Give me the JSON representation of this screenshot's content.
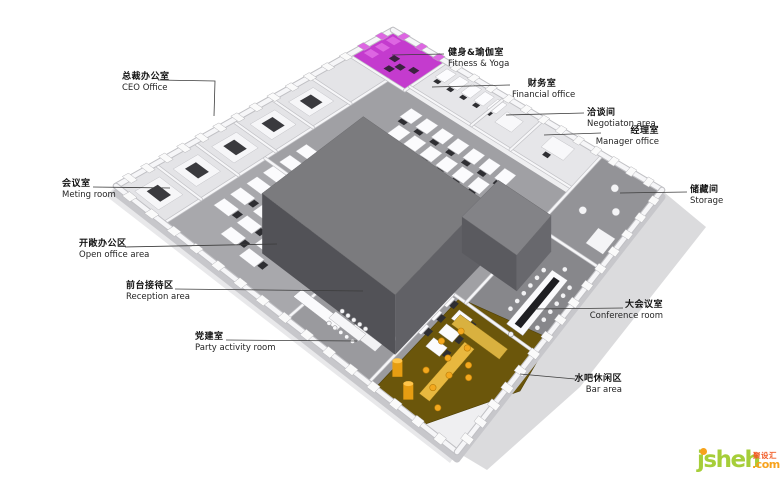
{
  "title": "Office floor plan 3D isometric diagram",
  "plan": {
    "colors": {
      "fitness": "#c43bce",
      "fitness_light": "#dd66e2",
      "bar_floor": "#6b560b",
      "bar_furniture": "#f3a81e",
      "core_top": "#7b7b7e",
      "core_left": "#525257",
      "core_right": "#616166",
      "core2_top": "#838387",
      "shadow": "#dbdbdd",
      "wall": "#f6f6f8",
      "floor_gray": "#9a9a9e"
    }
  },
  "callouts": [
    {
      "id": "ceo-office",
      "zh": "总裁办公室",
      "en": "CEO Office"
    },
    {
      "id": "fitness-yoga",
      "zh": "健身&瑜伽室",
      "en": "Fitness & Yoga"
    },
    {
      "id": "financial-office",
      "zh": "财务室",
      "en": "Financial office"
    },
    {
      "id": "negotiation-area",
      "zh": "洽谈间",
      "en": "Negotiaton area"
    },
    {
      "id": "manager-office",
      "zh": "经理室",
      "en": "Manager office"
    },
    {
      "id": "meeting-room",
      "zh": "会议室",
      "en": "Meting room"
    },
    {
      "id": "storage",
      "zh": "储藏间",
      "en": "Storage"
    },
    {
      "id": "open-office-area",
      "zh": "开敞办公区",
      "en": "Open office area"
    },
    {
      "id": "reception-area",
      "zh": "前台接待区",
      "en": "Reception area"
    },
    {
      "id": "conference-room",
      "zh": "大会议室",
      "en": "Conference room"
    },
    {
      "id": "party-activity-room",
      "zh": "党建室",
      "en": "Party activity room"
    },
    {
      "id": "bar-area",
      "zh": "水吧休闲区",
      "en": "Bar area"
    }
  ],
  "watermark": {
    "brand": "jsheh",
    "tld": ".com",
    "cn": "聚设汇",
    "colors": {
      "brand": "#a6ce39",
      "tld": "#f7a21b",
      "cn": "#f15a24"
    }
  }
}
